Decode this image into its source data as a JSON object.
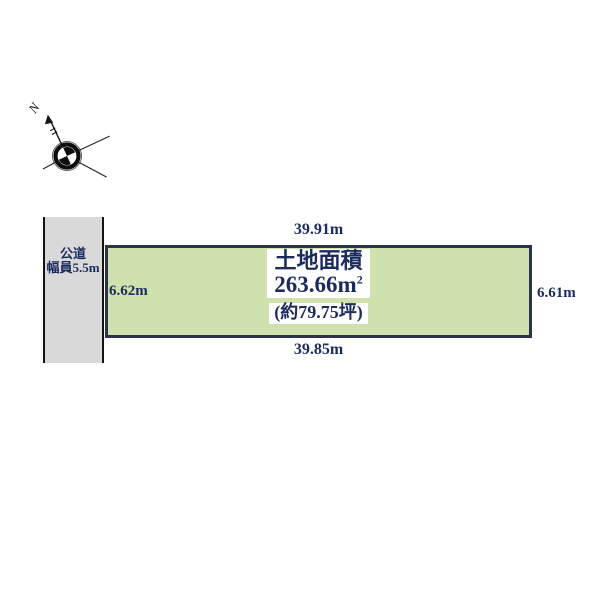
{
  "diagram": {
    "compass": {
      "north_label": "N"
    },
    "road": {
      "label_line1": "公道",
      "label_line2": "幅員5.5m"
    },
    "plot": {
      "area_title": "土地面積",
      "area_value": "263.66m",
      "area_sup": "2",
      "area_tsubo": "(約79.75坪)",
      "dim_top": "39.91m",
      "dim_bottom": "39.85m",
      "dim_left": "6.62m",
      "dim_right": "6.61m"
    },
    "colors": {
      "plot_fill": "#cfe2ad",
      "plot_border": "#2a3349",
      "road_fill": "#d9d9d9",
      "road_border": "#141414",
      "label_text": "#1c2b5e",
      "background": "#ffffff"
    }
  }
}
